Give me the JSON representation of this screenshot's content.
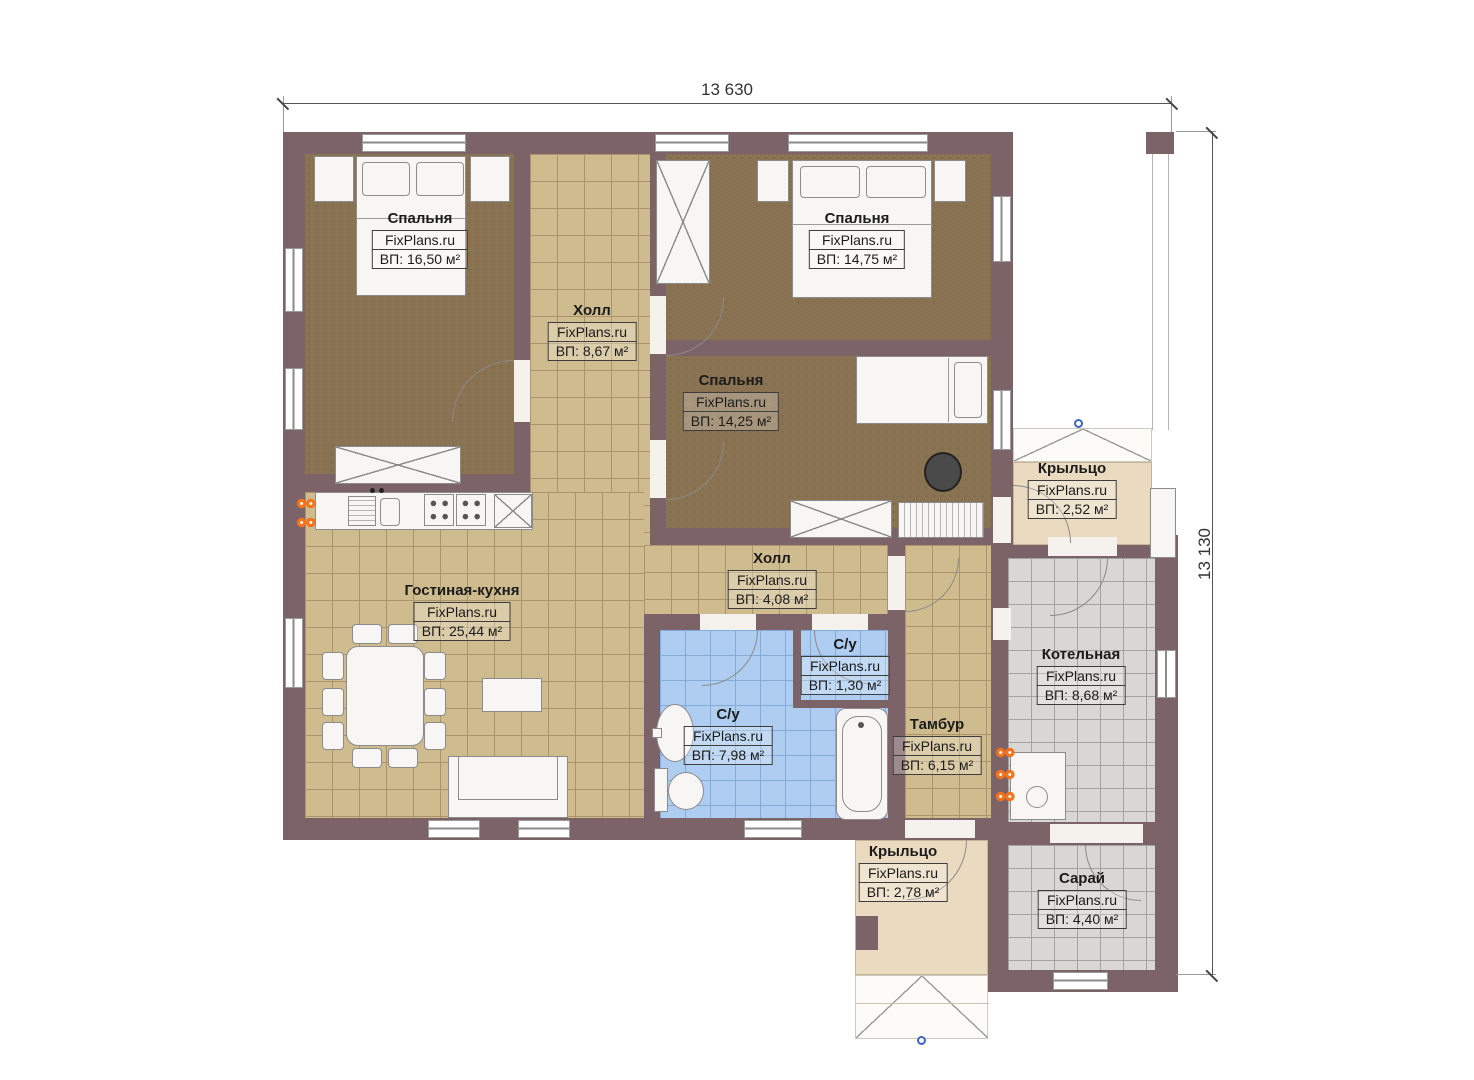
{
  "page": {
    "background": "#ffffff"
  },
  "dimensions": {
    "width_label": "13 630",
    "height_label": "13 130"
  },
  "brand": "FixPlans.ru",
  "rooms": [
    {
      "id": "bedroom-1",
      "name": "Спальня",
      "brand": "FixPlans.ru",
      "area": "ВП: 16,50 м²"
    },
    {
      "id": "hall-upper",
      "name": "Холл",
      "brand": "FixPlans.ru",
      "area": "ВП: 8,67 м²"
    },
    {
      "id": "bedroom-2",
      "name": "Спальня",
      "brand": "FixPlans.ru",
      "area": "ВП: 14,75 м²"
    },
    {
      "id": "bedroom-3",
      "name": "Спальня",
      "brand": "FixPlans.ru",
      "area": "ВП: 14,25 м²"
    },
    {
      "id": "porch-right",
      "name": "Крыльцо",
      "brand": "FixPlans.ru",
      "area": "ВП: 2,52 м²"
    },
    {
      "id": "living-kitchen",
      "name": "Гостиная-кухня",
      "brand": "FixPlans.ru",
      "area": "ВП: 25,44 м²"
    },
    {
      "id": "hall-lower",
      "name": "Холл",
      "brand": "FixPlans.ru",
      "area": "ВП: 4,08 м²"
    },
    {
      "id": "wc-small",
      "name": "С/у",
      "brand": "FixPlans.ru",
      "area": "ВП: 1,30 м²"
    },
    {
      "id": "wc-main",
      "name": "С/у",
      "brand": "FixPlans.ru",
      "area": "ВП: 7,98 м²"
    },
    {
      "id": "vestibule",
      "name": "Тамбур",
      "brand": "FixPlans.ru",
      "area": "ВП: 6,15 м²"
    },
    {
      "id": "boiler-room",
      "name": "Котельная",
      "brand": "FixPlans.ru",
      "area": "ВП: 8,68 м²"
    },
    {
      "id": "porch-bottom",
      "name": "Крыльцо",
      "brand": "FixPlans.ru",
      "area": "ВП: 2,78 м²"
    },
    {
      "id": "shed",
      "name": "Сарай",
      "brand": "FixPlans.ru",
      "area": "ВП: 4,40 м²"
    }
  ],
  "colors": {
    "wall": "#7c6367",
    "tile_tan": "#cfbc8e",
    "tile_blue": "#aecdf0",
    "tile_gray": "#d8d7d5",
    "carpet": "#8a7352",
    "porch": "#eadbc0",
    "radiator_accent": "#f4731c",
    "marker_blue": "#3f63c6"
  }
}
